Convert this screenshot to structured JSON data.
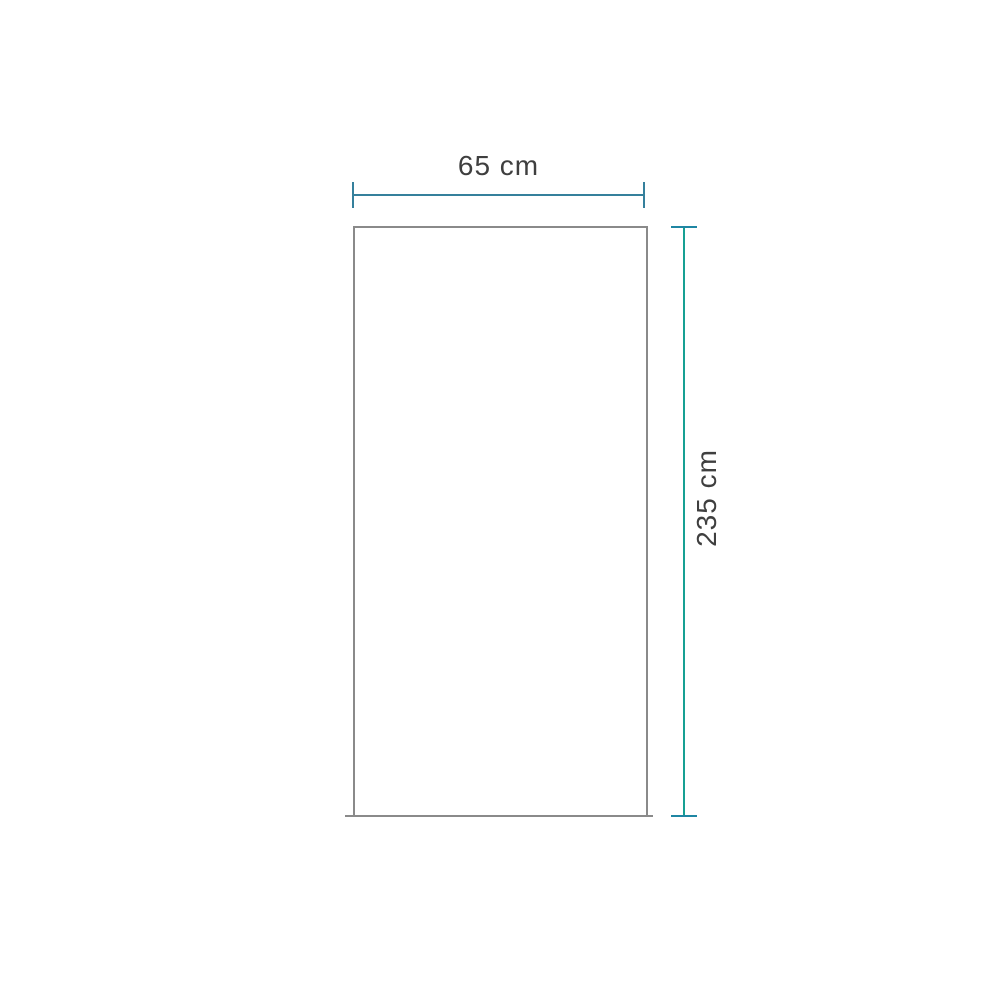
{
  "diagram": {
    "width_label": "65 cm",
    "height_label": "235 cm",
    "shape": {
      "width_cm": 65,
      "height_cm": 235
    },
    "colors": {
      "background": "#ffffff",
      "horizontal_dimension": "#35809c",
      "vertical_dimension_line": "#16a093",
      "vertical_dimension_caps": "#1f86a3",
      "outline": "#8a8a8a",
      "label_text": "#3f3f3f"
    }
  }
}
